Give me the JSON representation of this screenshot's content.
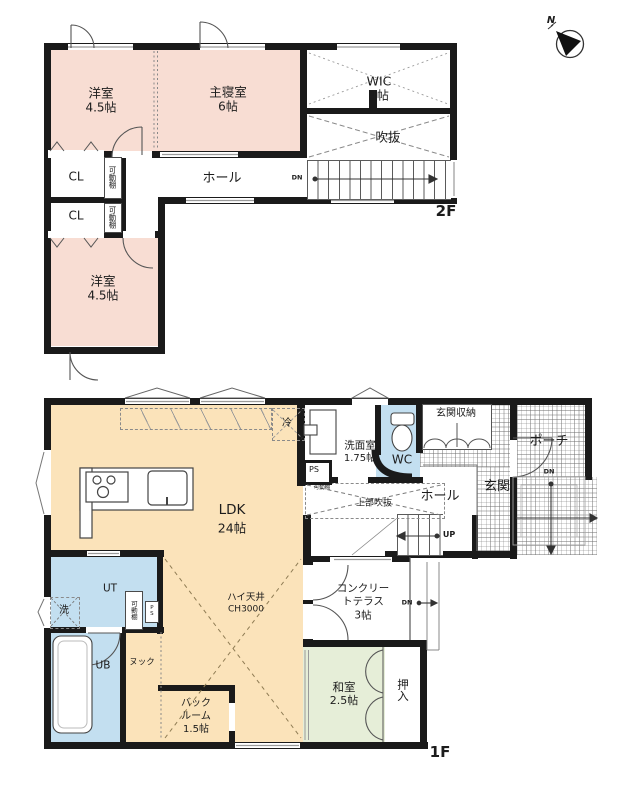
{
  "compass": {
    "north": "N"
  },
  "floor2": {
    "label": "2F",
    "dn": "DN",
    "rooms": {
      "yoshitsu_a": {
        "name": "洋室",
        "size": "4.5帖"
      },
      "master": {
        "name": "主寝室",
        "size": "6帖"
      },
      "wic": {
        "name": "WIC",
        "size": "4帖"
      },
      "void": {
        "name": "吹抜"
      },
      "hall": {
        "name": "ホール"
      },
      "cl_a": {
        "name": "CL"
      },
      "cl_b": {
        "name": "CL"
      },
      "shelf_a": {
        "name": "可動棚"
      },
      "shelf_b": {
        "name": "可動棚"
      },
      "yoshitsu_b": {
        "name": "洋室",
        "size": "4.5帖"
      }
    }
  },
  "floor1": {
    "label": "1F",
    "up": "UP",
    "dn_porch": "DN",
    "dn_side": "DN",
    "rooms": {
      "ldk": {
        "name": "LDK",
        "size": "24帖"
      },
      "high_ceiling": {
        "name": "ハイ天井",
        "size": "CH3000"
      },
      "fridge": {
        "name": "冷"
      },
      "laundry_room": {
        "name": "洗面室",
        "size": "1.75帖"
      },
      "wc": {
        "name": "WC"
      },
      "ps_a": {
        "name": "PS"
      },
      "ps_b": {
        "name": "PS"
      },
      "entry_storage": {
        "name": "玄関収納"
      },
      "entry": {
        "name": "玄関"
      },
      "porch": {
        "name": "ポーチ"
      },
      "hall": {
        "name": "ホール"
      },
      "upper_void": {
        "name": "上部吹抜"
      },
      "shelf_hall": {
        "name": "可動棚"
      },
      "shelf_ut": {
        "name": "可動棚"
      },
      "terrace": {
        "line1": "コンクリー",
        "line2": "トテラス",
        "size": "3帖"
      },
      "washitsu": {
        "name": "和室",
        "size": "2.5帖"
      },
      "oshiire": {
        "name": "押入"
      },
      "ut": {
        "name": "UT"
      },
      "washer": {
        "name": "洗"
      },
      "ub": {
        "name": "UB"
      },
      "nook": {
        "name": "ヌック"
      },
      "backroom": {
        "line1": "バック",
        "line2": "ルーム",
        "size": "1.5帖"
      }
    }
  }
}
